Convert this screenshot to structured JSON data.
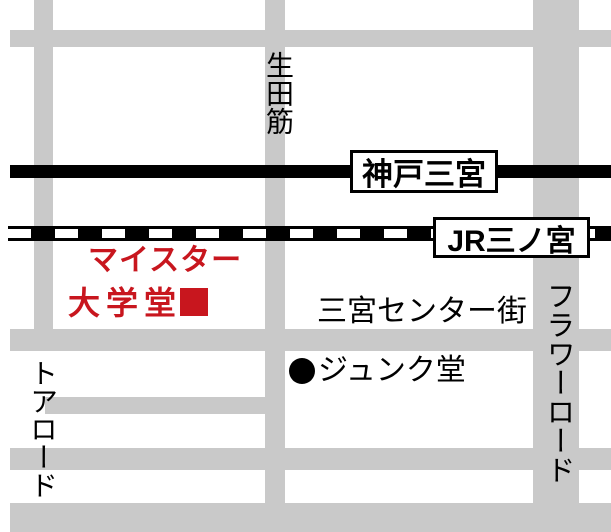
{
  "map": {
    "description_colors": {
      "road_gray": "#c9c9c9",
      "rail_black": "#000000",
      "accent_red": "#c8161e",
      "background": "#ffffff"
    },
    "station_labels": [
      {
        "id": "kobe-sannomiya",
        "text": "神戸三宮"
      },
      {
        "id": "jr-sannomiya",
        "text": "JR三ノ宮"
      }
    ],
    "streets": {
      "ikuta_suji": "生田筋",
      "tor_road": "トアロード",
      "flower_road": "フラワーロード",
      "center_gai": "三宮センター街"
    },
    "pois": {
      "shop": {
        "line1": "マイスター",
        "line2": "大学堂",
        "marker": "■",
        "marker_color": "#c8161e"
      },
      "junkudo": {
        "label": "ジュンク堂",
        "marker": "●"
      }
    }
  }
}
